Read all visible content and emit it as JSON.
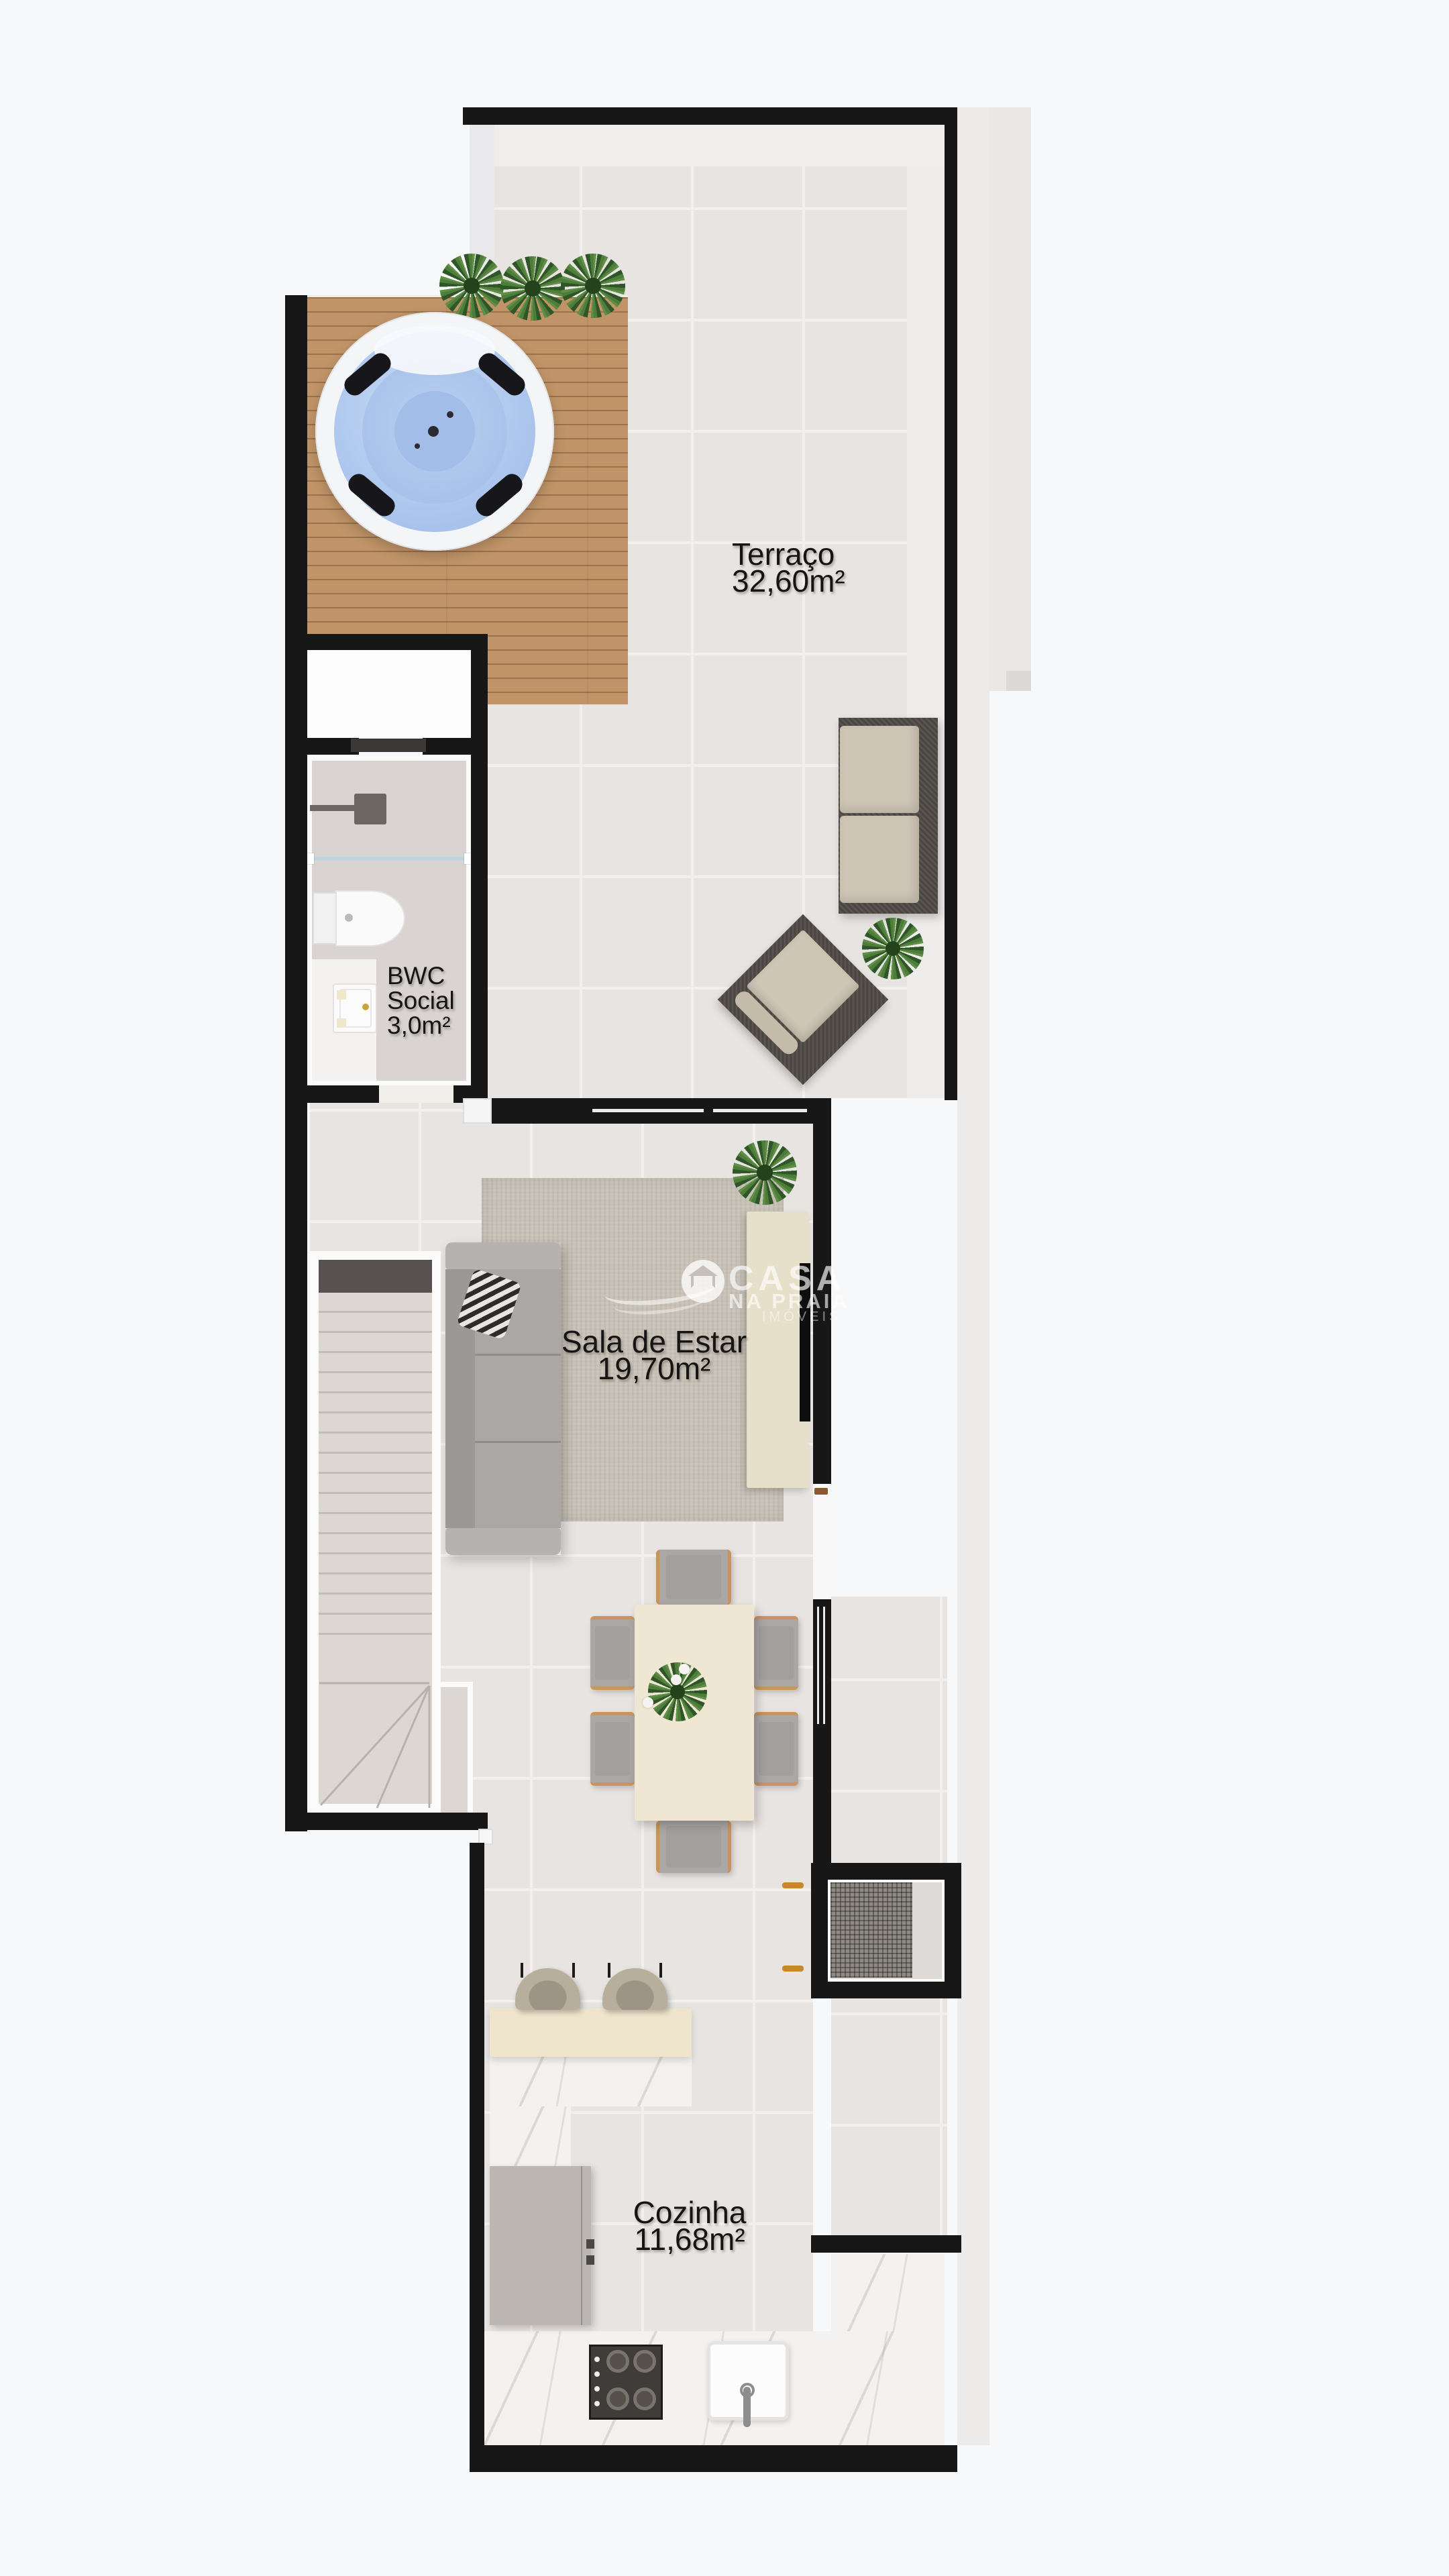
{
  "colors": {
    "wall": "#171717",
    "tile": "#E7E4E2",
    "grout": "#F2F0EE",
    "bg": "#F7F8FA",
    "deck": "#C09468",
    "water": "#AFC8EE",
    "tubrim": "#F4F5F7",
    "plant": "#4C7A38",
    "plantdark": "#2F5626",
    "rug": "#C7C1B6",
    "sofa": "#ABA7A5",
    "sofalight": "#B6B2B0",
    "sofadark": "#9C9896",
    "beige": "#EFE7D3",
    "wood": "#C8955F",
    "framedark": "#59544F",
    "cushion": "#CEC5B5",
    "stool": "#B7AF9C",
    "counter": "#EFE5CD",
    "marble": "#F4F2F0",
    "fridge": "#BCB7B3",
    "cooktop": "#403C39",
    "steel": "#8D8D8D",
    "bwcfloor": "#D9D4D1",
    "landing": "#575150",
    "stairfloor": "#DCD7D3",
    "tread": "#C2BCB8",
    "outside": "#EDEBE9",
    "neighbor": "#EAE7E5",
    "label": "#161514",
    "brass": "#C8872B",
    "glass": "#BDD2E3",
    "boxinner": "#8F8A84",
    "white": "#FBFBFB"
  },
  "rooms": {
    "terraco": {
      "name": "Terraço",
      "area": "32,60m²"
    },
    "bwc": {
      "name": "BWC",
      "name2": "Social",
      "area": "3,0m²"
    },
    "sala": {
      "name": "Sala de Estar",
      "area": "19,70m²"
    },
    "cozinha": {
      "name": "Cozinha",
      "area": "11,68m²"
    }
  },
  "watermark": {
    "brand_top": "CASA",
    "brand_mid": "NA PRAIA",
    "brand_sub": "IMÓVEIS"
  }
}
